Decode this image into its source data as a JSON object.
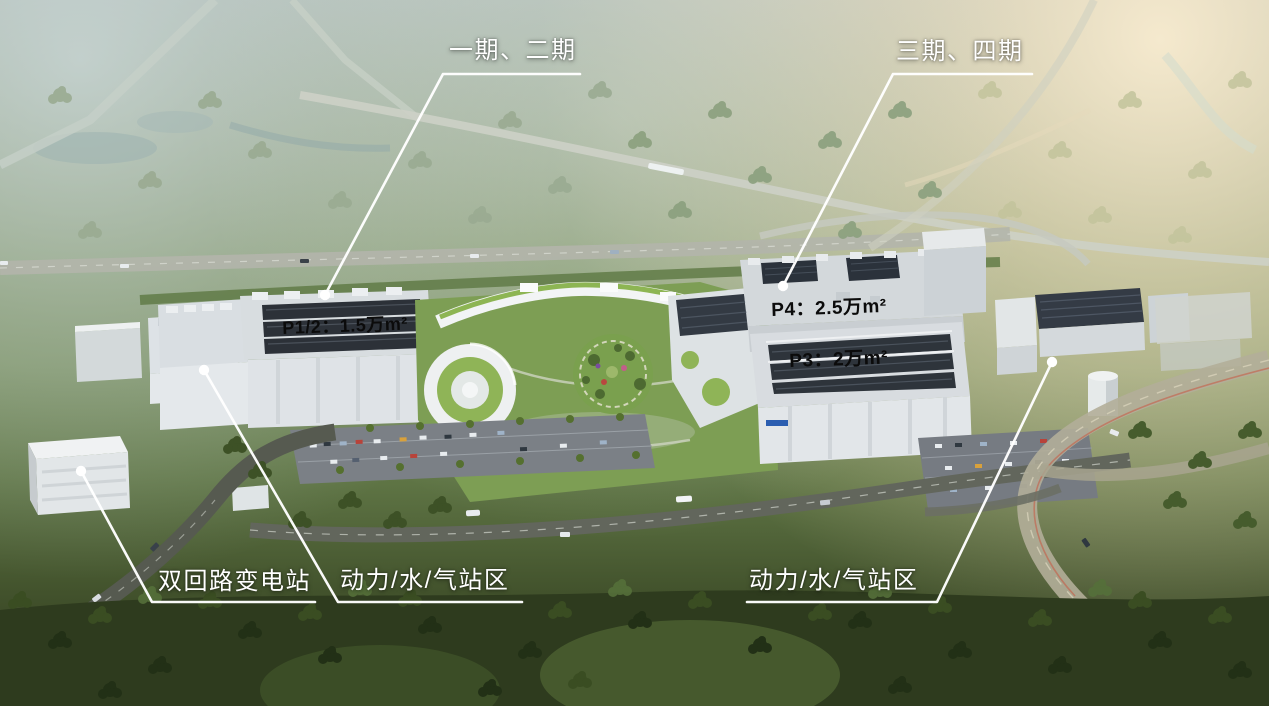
{
  "annotations": {
    "phase_1_2": "一期、二期",
    "phase_3_4": "三期、四期",
    "p12_area": "P1/2：1.5万m²",
    "p4_area": "P4：2.5万m²",
    "p3_area": "P3：2万m²",
    "substation": "双回路变电站",
    "utility_left": "动力/水/气站区",
    "utility_right": "动力/水/气站区"
  },
  "colors": {
    "leader_line": "#ffffff",
    "marker_dot": "#ffffff",
    "light_label_text": "#ffffff",
    "dark_label_text": "#0b0b0b"
  }
}
